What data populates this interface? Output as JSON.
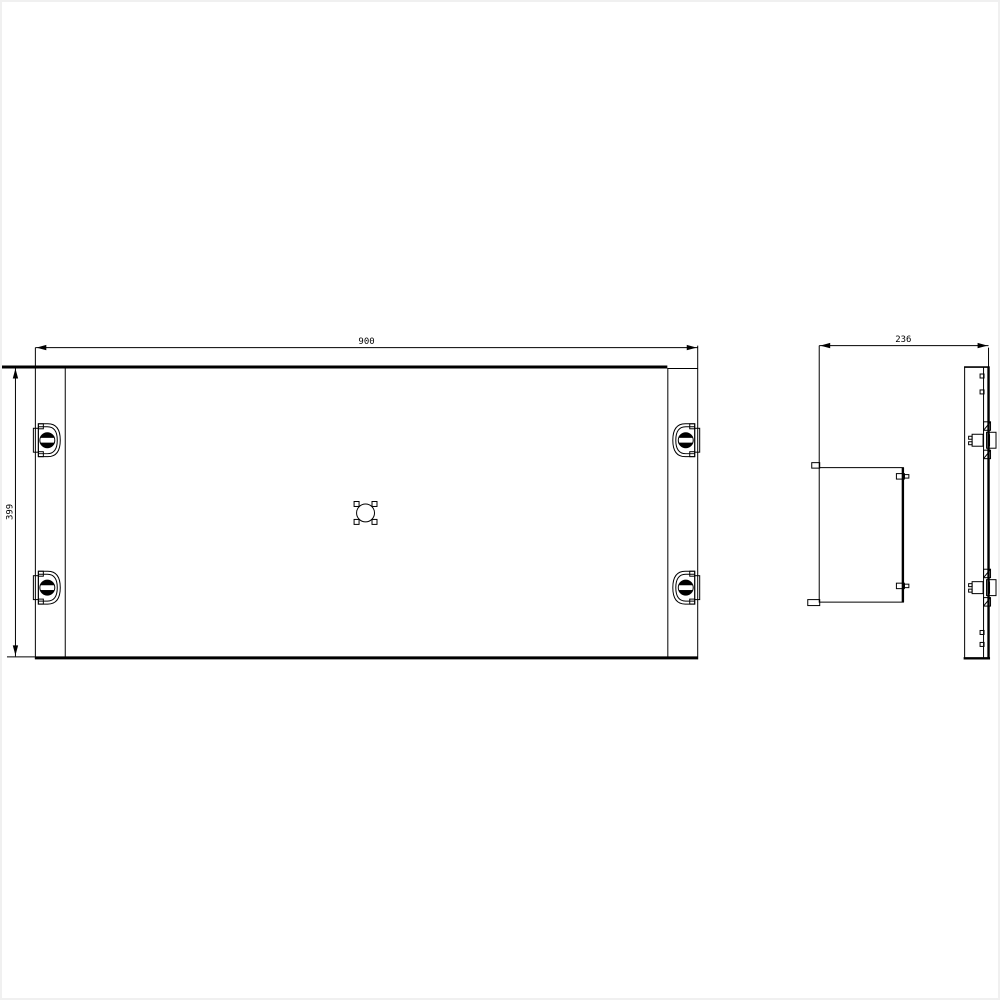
{
  "front_view": {
    "width_dim": "900",
    "height_dim": "399"
  },
  "side_view": {
    "depth_dim": "236"
  },
  "colors": {
    "line": "#000000",
    "background": "#ffffff",
    "frame": "#f0f0f0"
  }
}
